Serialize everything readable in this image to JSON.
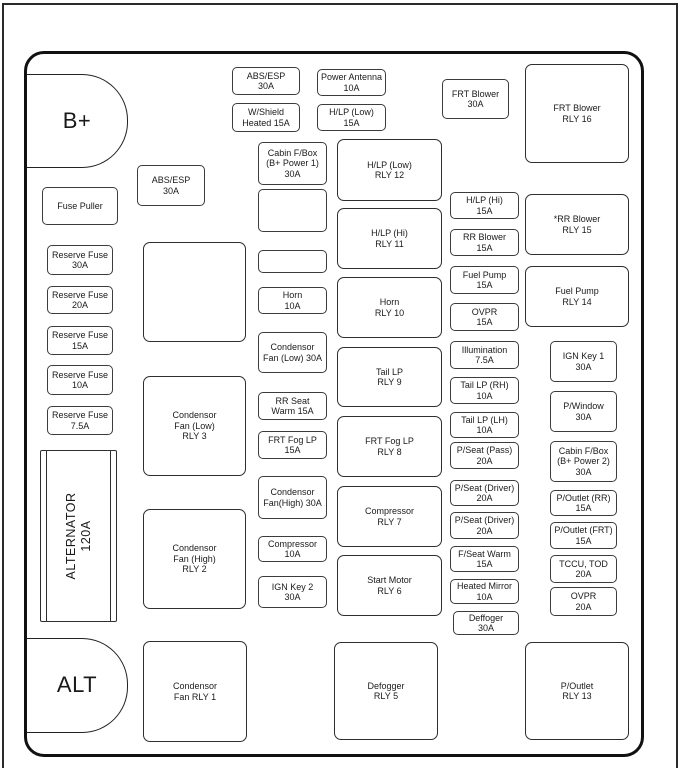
{
  "colors": {
    "line": "#1a1a1a",
    "background": "#ffffff"
  },
  "terminals": {
    "b_plus": "B+",
    "alt": "ALT",
    "alternator": "ALTERNATOR\n120A"
  },
  "tools": {
    "fuse_puller": "Fuse Puller"
  },
  "fuses": {
    "abs_esp_top": "ABS/ESP\n30A",
    "wshield_heated": "W/Shield\nHeated 15A",
    "power_antenna": "Power Antenna\n10A",
    "hlp_low": "H/LP (Low)\n15A",
    "frt_blower": "FRT Blower\n30A",
    "abs_esp_2": "ABS/ESP\n30A",
    "cabin_fbox_b1": "Cabin F/Box\n(B+ Power 1)\n30A",
    "horn": "Horn\n10A",
    "condensor_fan_low": "Condensor\nFan (Low) 30A",
    "rr_seat_warm": "RR Seat\nWarm 15A",
    "frt_fog_lp": "FRT Fog LP\n15A",
    "condensor_fan_high": "Condensor\nFan(High) 30A",
    "compressor": "Compressor\n10A",
    "ign_key_2": "IGN Key 2\n30A",
    "reserve_30": "Reserve Fuse\n30A",
    "reserve_20": "Reserve Fuse\n20A",
    "reserve_15": "Reserve Fuse\n15A",
    "reserve_10": "Reserve Fuse\n10A",
    "reserve_7_5": "Reserve Fuse\n7.5A",
    "hlp_hi": "H/LP (Hi)\n15A",
    "rr_blower": "RR Blower\n15A",
    "fuel_pump": "Fuel Pump\n15A",
    "ovpr_15": "OVPR\n15A",
    "illumination": "Illumination\n7.5A",
    "tail_lp_rh": "Tail LP (RH)\n10A",
    "tail_lp_lh": "Tail LP (LH)\n10A",
    "p_seat_pass": "P/Seat (Pass)\n20A",
    "p_seat_driver_1": "P/Seat (Driver)\n20A",
    "p_seat_driver_2": "P/Seat (Driver)\n20A",
    "f_seat_warm": "F/Seat Warm\n15A",
    "heated_mirror": "Heated Mirror\n10A",
    "deffoger": "Deffoger\n30A",
    "ign_key_1": "IGN Key 1\n30A",
    "p_window": "P/Window\n30A",
    "cabin_fbox_b2": "Cabin F/Box\n(B+ Power 2)\n30A",
    "p_outlet_rr": "P/Outlet (RR)\n15A",
    "p_outlet_frt": "P/Outlet (FRT)\n15A",
    "tccu_tod": "TCCU, TOD\n20A",
    "ovpr_20": "OVPR\n20A"
  },
  "relays": {
    "rly_16": "FRT Blower\nRLY 16",
    "rly_15": "*RR Blower\nRLY 15",
    "rly_14": "Fuel Pump\nRLY 14",
    "rly_13": "P/Outlet\nRLY 13",
    "rly_12": "H/LP (Low)\nRLY 12",
    "rly_11": "H/LP (Hi)\nRLY 11",
    "rly_10": "Horn\nRLY 10",
    "rly_9": "Tail LP\nRLY 9",
    "rly_8": "FRT Fog LP\nRLY 8",
    "rly_7": "Compressor\nRLY 7",
    "rly_6": "Start Motor\nRLY 6",
    "rly_5": "Defogger\nRLY 5",
    "rly_3": "Condensor\nFan (Low)\nRLY 3",
    "rly_2": "Condensor\nFan (High)\nRLY 2",
    "rly_1": "Condensor\nFan RLY 1"
  }
}
